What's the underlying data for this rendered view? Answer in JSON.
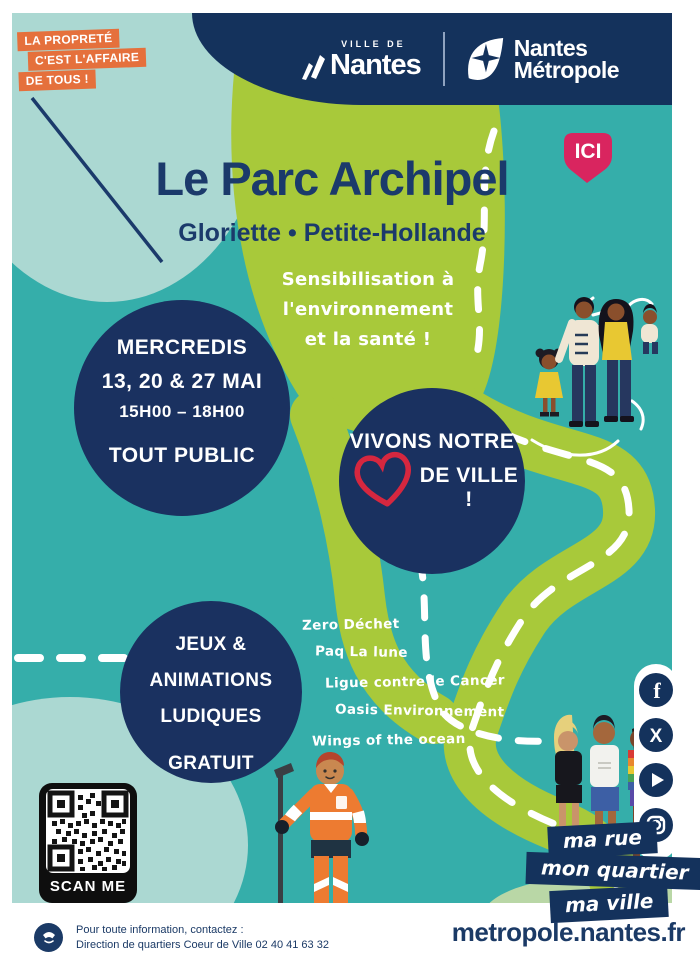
{
  "colors": {
    "teal_background": "#35aeaa",
    "pale_blue_blob": "#abd8d2",
    "path_green": "#a8c93a",
    "navy": "#14325c",
    "badge_orange": "#e5703c",
    "ici_pink": "#d9255f",
    "heart_red": "#d6273f"
  },
  "cleanliness_badge": {
    "line1": "LA PROPRETÉ",
    "line2": "C'EST L'AFFAIRE",
    "line3": "DE TOUS !"
  },
  "header": {
    "ville_de": "VILLE DE",
    "nantes": "Nantes",
    "metropole_line1": "Nantes",
    "metropole_line2": "Métropole"
  },
  "hero": {
    "title": "Le Parc Archipel",
    "subtitle": "Gloriette • Petite-Hollande",
    "ici_label": "ICI",
    "tagline_line1": "Sensibilisation à",
    "tagline_line2": "l'environnement",
    "tagline_line3": "et la santé !"
  },
  "schedule_circle": {
    "days": "MERCREDIS",
    "dates": "13, 20 & 27 MAI",
    "hours": "15H00 – 18H00",
    "audience": "TOUT PUBLIC"
  },
  "motto_circle": {
    "line1": "VIVONS NOTRE",
    "line2": "DE VILLE !"
  },
  "activities_circle": {
    "line1": "JEUX &",
    "line2": "ANIMATIONS",
    "line3": "LUDIQUES",
    "free_label": "GRATUIT"
  },
  "partners": [
    "Zero Déchet",
    "Paq La lune",
    "Ligue contre le Cancer",
    "Oasis Environnement",
    "Wings of the ocean"
  ],
  "qr": {
    "label": "SCAN ME"
  },
  "social_icons": [
    "facebook",
    "x",
    "youtube",
    "instagram"
  ],
  "city_badges": {
    "badge1": "ma rue",
    "badge2": "mon quartier",
    "badge3": "ma ville"
  },
  "footer": {
    "contact_line1": "Pour toute information, contactez :",
    "contact_line2": "Direction de quartiers Coeur de Ville 02 40 41 63 32",
    "website": "metropole.nantes.fr"
  }
}
